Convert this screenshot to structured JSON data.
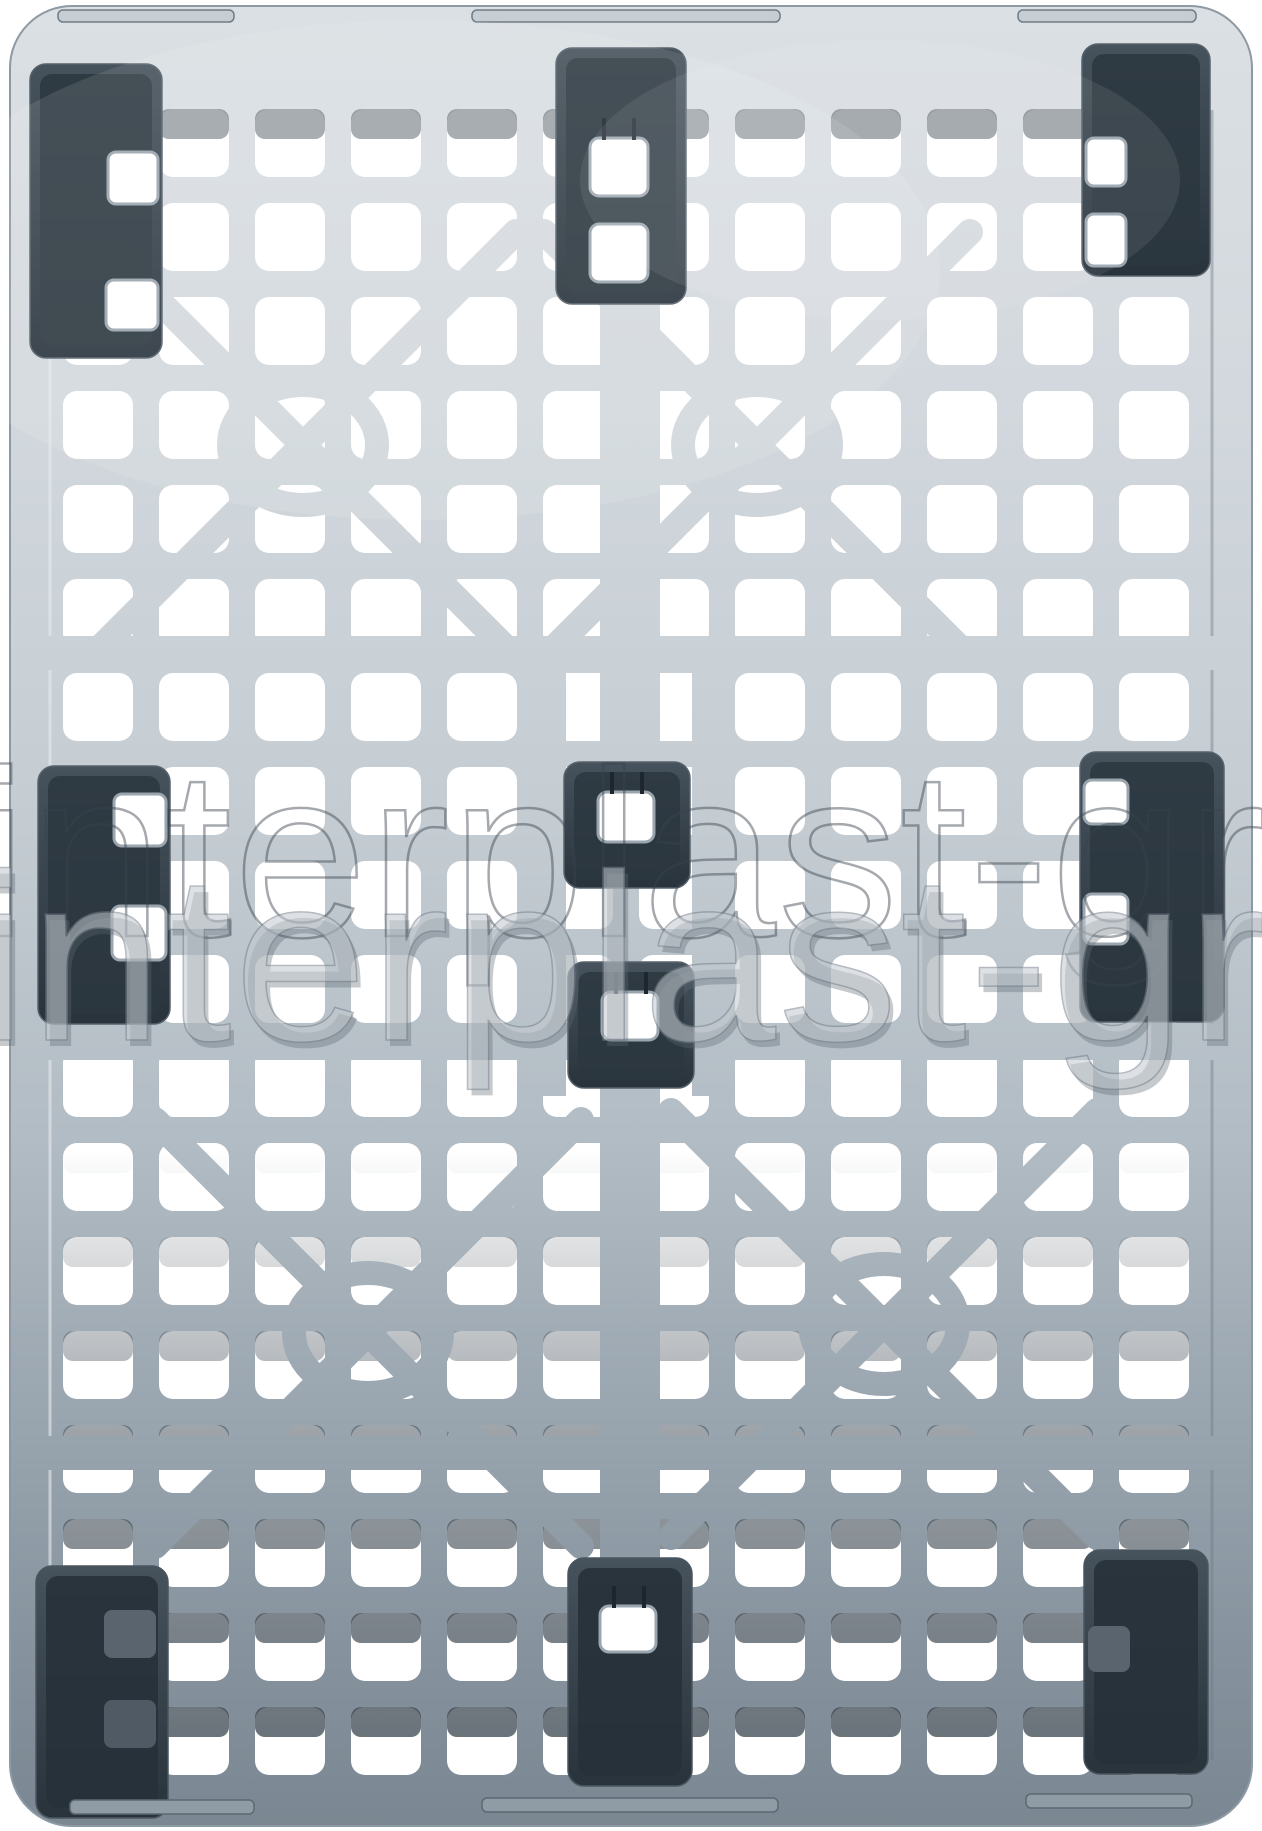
{
  "scene": {
    "subject": "gray plastic industrial pallet, top view product photo",
    "background": "white"
  },
  "watermark": {
    "text": "interplast-gro"
  },
  "palette": {
    "pallet_light": "#d7dde2",
    "pallet_mid": "#b4bec6",
    "pallet_dark": "#7a8792",
    "foot_dark": "#39444e",
    "foot_inner_shadow": "#2a343d",
    "hole_white": "#ffffff",
    "slot_shadow": "#3f4a54",
    "watermark_fill": "#c3cad0",
    "watermark_outline": "#39434d"
  }
}
